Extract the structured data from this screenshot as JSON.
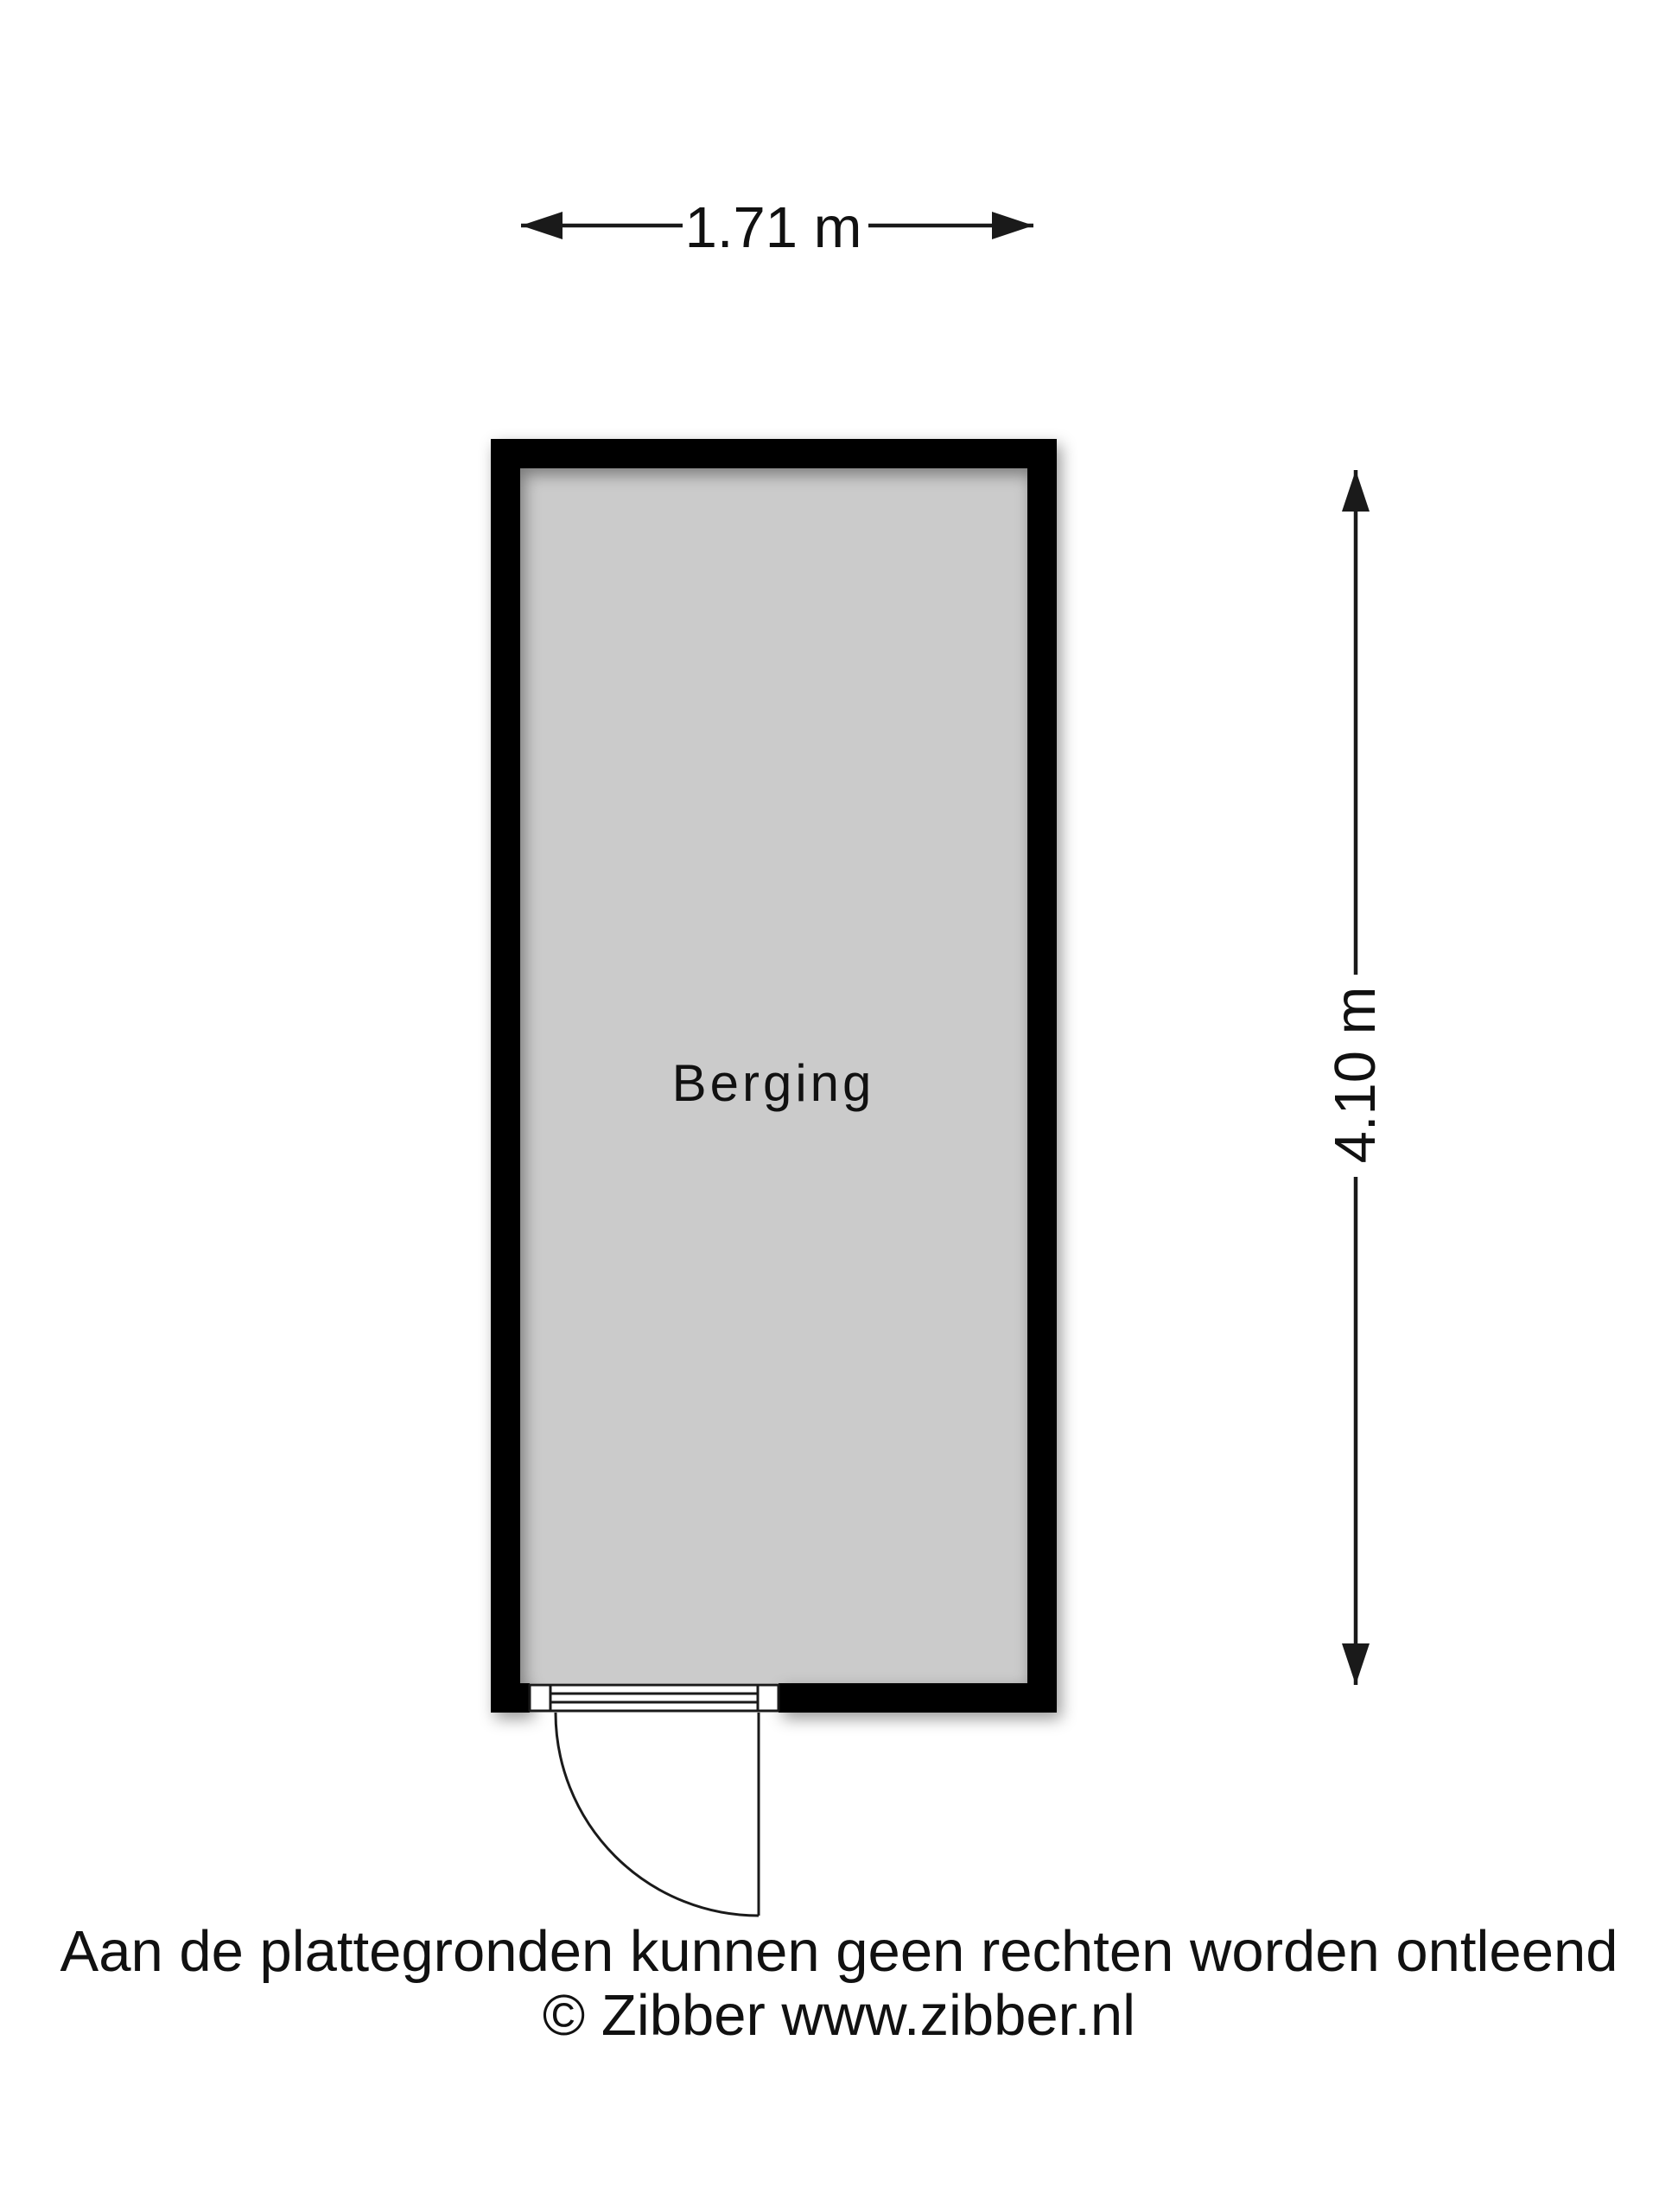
{
  "plan": {
    "room": {
      "label": "Berging"
    },
    "dimensions": {
      "width_label": "1.71 m",
      "height_label": "4.10 m"
    },
    "door": {
      "type": "single-swing-door",
      "location": "bottom-wall-left"
    }
  },
  "footer": {
    "disclaimer": "Aan de plattegronden kunnen geen rechten worden ontleend",
    "copyright": "© Zibber www.zibber.nl"
  },
  "colors": {
    "background": "#ffffff",
    "wall": "#000000",
    "floor": "#cbcbcb",
    "line": "#1a1a1a",
    "text": "#111111"
  }
}
